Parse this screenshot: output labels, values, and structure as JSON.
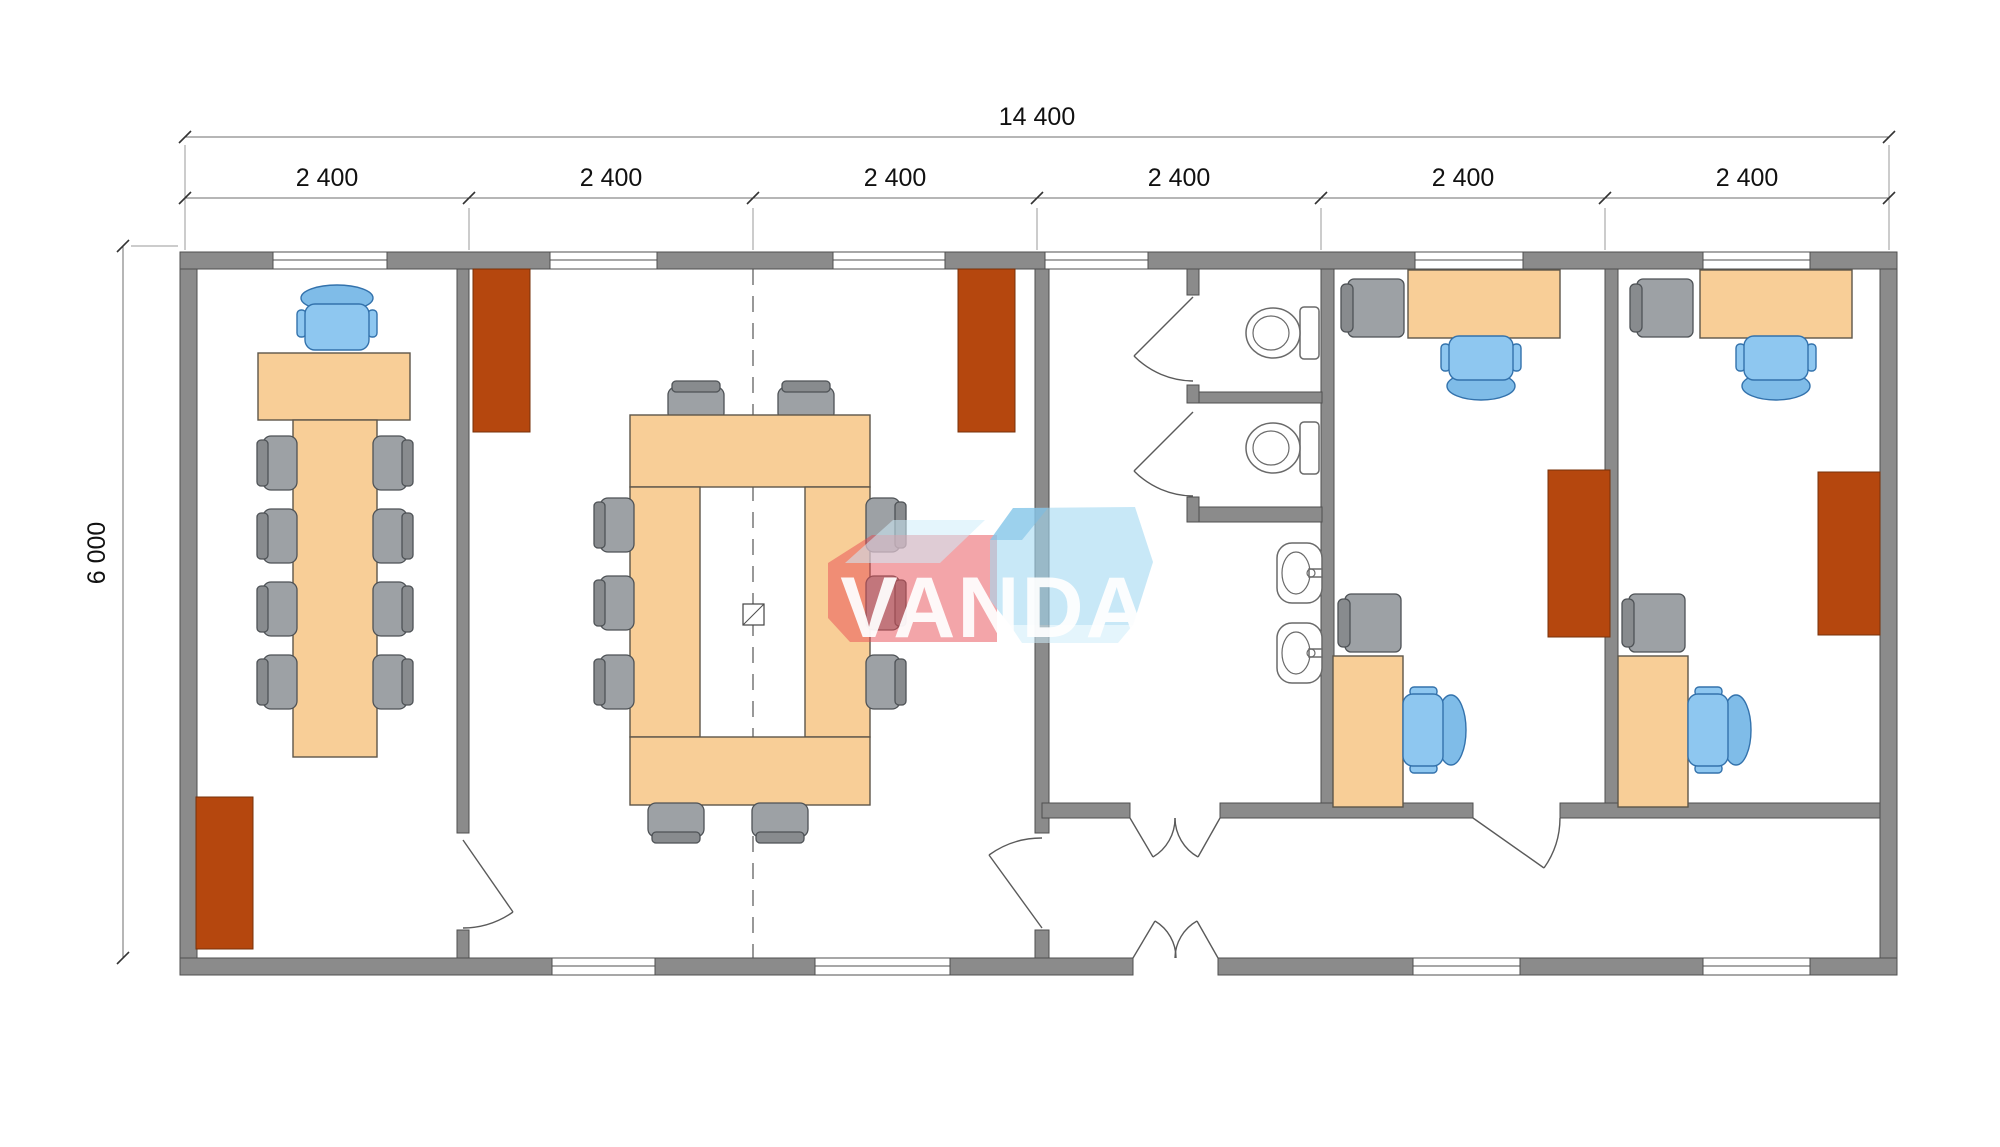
{
  "drawing": {
    "type": "modular-building-floor-plan",
    "watermark": {
      "text": "VANDA"
    },
    "dimensions": {
      "overall_width": "14 400",
      "overall_height": "6 000",
      "modules": [
        "2 400",
        "2 400",
        "2 400",
        "2 400",
        "2 400",
        "2 400"
      ]
    },
    "elements": {
      "rooms": [
        "meeting-room",
        "conference-room",
        "wc-corridor",
        "wc-stall-1",
        "wc-stall-2",
        "entrance-vestibule",
        "office-1",
        "office-2"
      ],
      "icons": [
        "meeting-table",
        "executive-chair",
        "side-chair",
        "conference-ring-table",
        "structural-column",
        "radiator",
        "toilet",
        "wash-basin",
        "desk",
        "task-chair",
        "visitor-chair",
        "window",
        "door-swing",
        "module-joint-dashed-line"
      ]
    }
  },
  "colors": {
    "background": "#FFFFFF",
    "wall": "#8B8B8B",
    "wall_stroke": "#4F4F4F",
    "furniture_tan": "#F8CE97",
    "furniture_stroke": "#5D564A",
    "chair_gray": "#9DA1A5",
    "chair_gray_dark": "#888B8E",
    "chair_stroke": "#4E5256",
    "chair_blue": "#8EC7F0",
    "chair_blue_dark": "#7FBCE8",
    "chair_blue_stroke": "#3372AC",
    "radiator": "#B5470E",
    "radiator_stroke": "#77300A",
    "door_line": "#5A5A5A",
    "fixture_stroke": "#6A6A6A",
    "dim_line": "#6E6E6E",
    "dim_text": "#111111",
    "dash_line": "#555555",
    "watermark_red": "rgba(231,76,84,0.50)",
    "watermark_blue": "rgba(164,216,242,0.60)",
    "watermark_blue_light": "rgba(205,236,250,0.55)",
    "watermark_blue_deep": "rgba(120,190,230,0.55)",
    "watermark_text": "#FFFFFF"
  }
}
